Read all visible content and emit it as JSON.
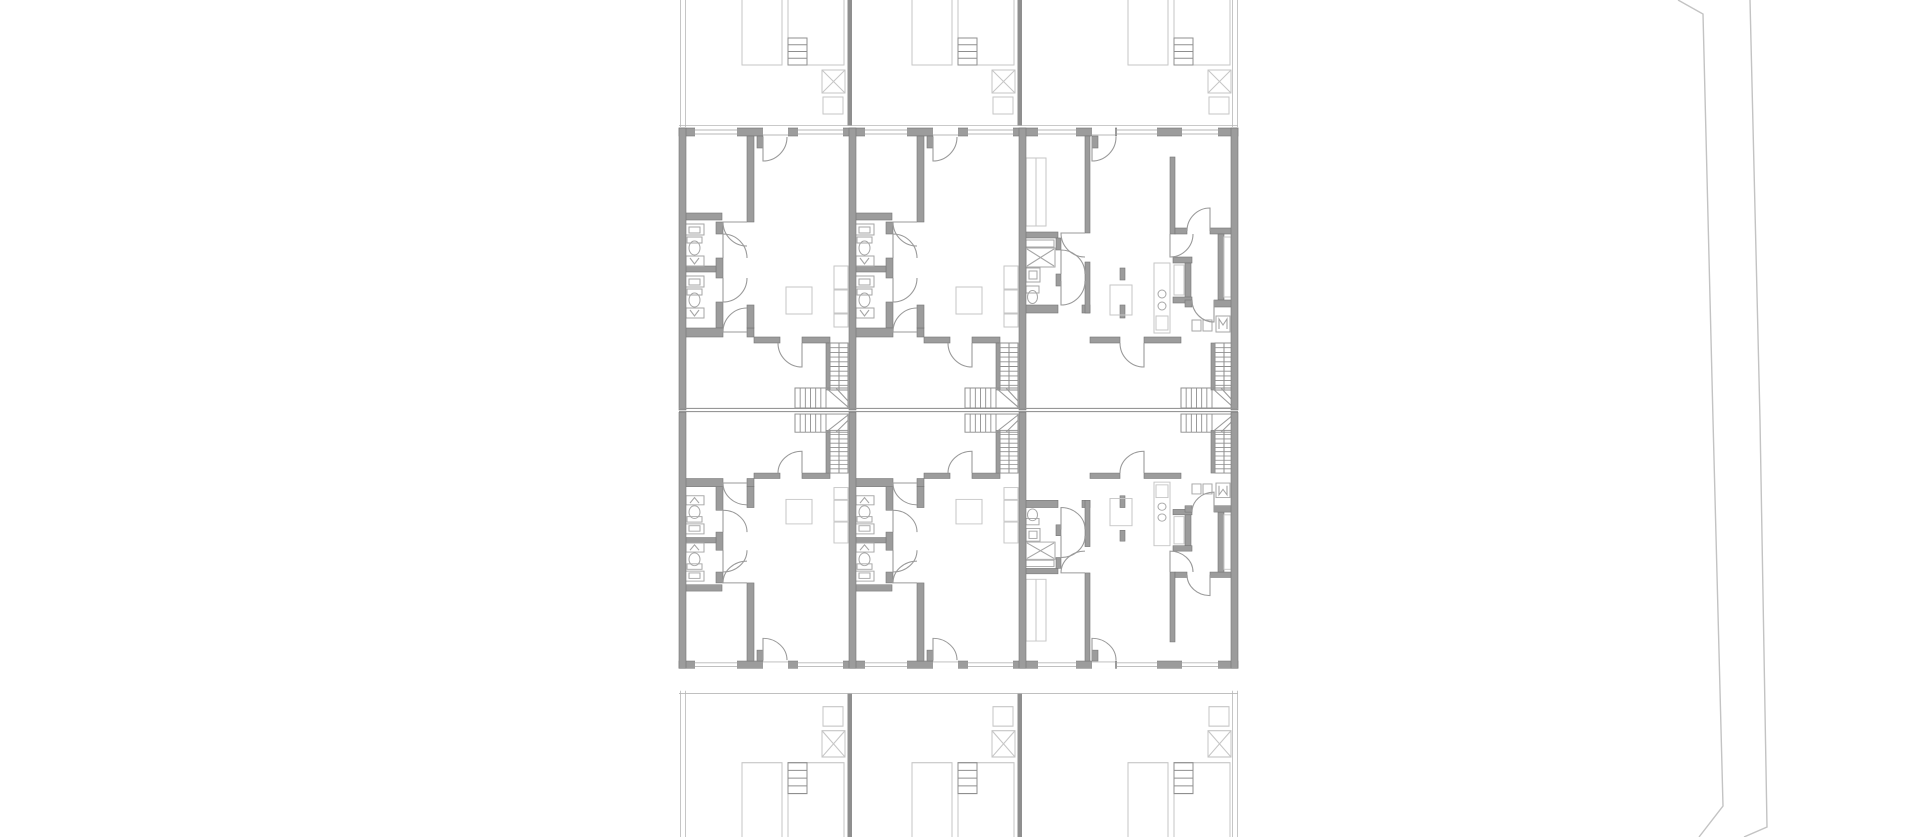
{
  "meta": {
    "drawing_label": "architectural-floor-plan",
    "background": "#ffffff"
  },
  "palette": {
    "wall_fill": "#9c9c9c",
    "wall_edge": "#757575",
    "fixture": "#a6a6a6",
    "light": "#c6c6c6",
    "stair": "#8f8f8f",
    "door": "#9a9a9a",
    "sill": "#b7b7b7",
    "road": "#c3c3c3",
    "mirror_line": "#979797"
  },
  "plan": {
    "left": 679,
    "right": 1238,
    "top_wall_y": 128,
    "top_wall_h": 8,
    "mirror_y": [
      408.4,
      411.6
    ],
    "apartment_mirror_transform": "translate(0,784.5) scale(1,-0.908)",
    "yard_mirror_transform": "translate(0,837) scale(1,-1.143)",
    "party_walls_x": [
      679,
      849,
      1019,
      1231
    ],
    "party_wall_w": 7,
    "yard_dividers_x": [
      847.5,
      1017.5
    ],
    "yard_boundary_x": [
      680.5,
      685.5,
      1232.5,
      1237.5
    ],
    "yard_edge_y": 125.5,
    "units": [
      {
        "x": 682,
        "template": "A",
        "yard": "yardA"
      },
      {
        "x": 852,
        "template": "A",
        "yard": "yardA"
      },
      {
        "x": 1022,
        "template": "B",
        "yard": "yardB"
      }
    ],
    "templates": {
      "A": {
        "windows": [
          [
            13,
            42
          ],
          [
            116,
            45
          ]
        ],
        "door": [
          81,
          25
        ],
        "prims": [
          [
            "w",
            65,
            136,
            7,
            86
          ],
          [
            "w",
            75,
            136,
            6,
            12
          ],
          [
            "w",
            3,
            213,
            37,
            7
          ],
          [
            "w",
            34,
            222,
            7,
            12
          ],
          [
            "w",
            34,
            258,
            7,
            20
          ],
          [
            "w",
            34,
            302,
            7,
            26
          ],
          [
            "w",
            3,
            266,
            31,
            6
          ],
          [
            "w",
            3,
            328,
            38,
            9
          ],
          [
            "w",
            65,
            328,
            7,
            9
          ],
          [
            "w",
            65,
            305,
            7,
            23
          ],
          [
            "w",
            72,
            337,
            26,
            6
          ],
          [
            "w",
            120,
            337,
            28,
            6
          ],
          [
            "w",
            144,
            343,
            4,
            47
          ],
          [
            "f",
            3,
            224,
            19,
            11
          ],
          [
            "f",
            7,
            227,
            11,
            6
          ],
          [
            "f",
            5,
            237,
            15,
            6
          ],
          [
            "e",
            12.5,
            248,
            5.5,
            7
          ],
          [
            "f",
            4,
            256,
            18,
            10
          ],
          [
            "pf",
            "M8 258 L12.5 264 L17 258"
          ],
          [
            "f",
            3,
            276,
            19,
            11
          ],
          [
            "f",
            7,
            279,
            11,
            6
          ],
          [
            "f",
            5,
            289,
            15,
            6
          ],
          [
            "e",
            12.5,
            300,
            5.5,
            7
          ],
          [
            "f",
            4,
            308,
            18,
            10
          ],
          [
            "pf",
            "M8 310 L12.5 316 L17 310"
          ],
          [
            "g",
            104,
            287,
            26,
            27
          ],
          [
            "g",
            152,
            266,
            14,
            23
          ],
          [
            "g",
            152,
            290,
            14,
            23
          ],
          [
            "g",
            152,
            314,
            14,
            13
          ],
          [
            "sv",
            148,
            343,
            18,
            47,
            9
          ],
          [
            "ml",
            157,
            343,
            157,
            390
          ],
          [
            "sv",
            113,
            388,
            53,
            20,
            0
          ],
          [
            "sh",
            113,
            388,
            31,
            20,
            6
          ],
          [
            "p",
            "M144 388 L166 407"
          ],
          [
            "p",
            "M154 388 L166 401"
          ],
          [
            "p",
            "M81 137 L81 161 A24 24 0 0 0 105 137"
          ],
          [
            "p",
            "M65 222 L41 222 A24 24 0 0 0 65 246"
          ],
          [
            "p",
            "M41 258 L41 234 A24 24 0 0 1 65 258"
          ],
          [
            "p",
            "M41 278 L41 302 A24 24 0 0 0 65 278"
          ],
          [
            "p",
            "M65 332 L41 332 A24 24 0 0 1 65 308"
          ],
          [
            "p",
            "M120 343 L120 367 A24 24 0 0 1 96 343"
          ]
        ]
      },
      "B": {
        "windows": [
          [
            16,
            38
          ],
          [
            95,
            40
          ],
          [
            160,
            36
          ]
        ],
        "door": [
          70,
          23
        ],
        "prims": [
          [
            "w",
            63,
            136,
            5,
            97
          ],
          [
            "w",
            70,
            136,
            6,
            12
          ],
          [
            "w",
            3,
            232,
            33,
            6
          ],
          [
            "w",
            34,
            238,
            5,
            12
          ],
          [
            "w",
            34,
            274,
            5,
            12
          ],
          [
            "w",
            0,
            305,
            36,
            8
          ],
          [
            "w",
            60,
            305,
            8,
            8
          ],
          [
            "w",
            63,
            262,
            5,
            51
          ],
          [
            "w",
            68,
            337,
            30,
            6
          ],
          [
            "w",
            122,
            337,
            37,
            6
          ],
          [
            "w",
            189,
            343,
            4,
            47
          ],
          [
            "w",
            148,
            157,
            5,
            77
          ],
          [
            "w",
            153,
            228,
            12,
            6
          ],
          [
            "w",
            188,
            228,
            23,
            6
          ],
          [
            "w",
            151,
            257,
            19,
            6
          ],
          [
            "w",
            163,
            263,
            6,
            40
          ],
          [
            "w",
            151,
            297,
            19,
            6
          ],
          [
            "w",
            196,
            234,
            6,
            66
          ],
          [
            "w",
            163,
            300,
            7,
            7
          ],
          [
            "w",
            192,
            300,
            19,
            7
          ],
          [
            "w",
            98,
            268,
            5,
            12
          ],
          [
            "w",
            98,
            305,
            5,
            13
          ],
          [
            "g",
            4,
            158,
            20,
            68
          ],
          [
            "gl",
            14,
            158,
            14,
            226
          ],
          [
            "f",
            4,
            240,
            28,
            7
          ],
          [
            "f",
            4,
            248,
            29,
            19
          ],
          [
            "pf",
            "M5 249 L32 266"
          ],
          [
            "pf",
            "M32 249 L5 266"
          ],
          [
            "f",
            4,
            268,
            14,
            14
          ],
          [
            "f",
            7,
            271,
            8,
            8
          ],
          [
            "f",
            4,
            286,
            13,
            7
          ],
          [
            "e",
            10.5,
            297,
            5,
            6.5
          ],
          [
            "g",
            132,
            263,
            16,
            70
          ],
          [
            "g",
            134,
            316,
            12,
            14
          ],
          [
            "c",
            140,
            294,
            4
          ],
          [
            "c",
            140,
            306,
            4
          ],
          [
            "g",
            152,
            265,
            10,
            30
          ],
          [
            "g",
            202,
            237,
            7,
            60
          ],
          [
            "f",
            170,
            320,
            9,
            11
          ],
          [
            "f",
            181,
            320,
            9,
            11
          ],
          [
            "f",
            194,
            316,
            14,
            16
          ],
          [
            "pf",
            "M197 329 L197 319 L201 325 L205 319 L205 329"
          ],
          [
            "g",
            88,
            285,
            22,
            30
          ],
          [
            "sv",
            193,
            343,
            18,
            47,
            9
          ],
          [
            "ml",
            202,
            343,
            202,
            390
          ],
          [
            "sv",
            159,
            388,
            52,
            20,
            0
          ],
          [
            "sh",
            159,
            388,
            31,
            20,
            6
          ],
          [
            "p",
            "M190 388 L211 407"
          ],
          [
            "p",
            "M199 388 L211 401"
          ],
          [
            "p",
            "M70 137 L70 161 A24 24 0 0 0 94 137"
          ],
          [
            "p",
            "M63 233 L39 233 A24 24 0 0 0 63 257"
          ],
          [
            "p",
            "M39 274 L39 250 A24 24 0 0 1 63 274"
          ],
          [
            "p",
            "M39 281 L39 305 A24 24 0 0 0 63 281"
          ],
          [
            "p",
            "M122 343 L122 367 A24 24 0 0 1 98 343"
          ],
          [
            "p",
            "M188 231 L188 208 A23 23 0 0 0 165 231"
          ],
          [
            "p",
            "M148 234 L148 257 A23 23 0 0 0 171 234"
          ],
          [
            "p",
            "M192 300 L192 322 A22 22 0 0 1 170 300"
          ]
        ]
      },
      "yardA": {
        "prims": [
          [
            "g",
            60,
            -20,
            40,
            85
          ],
          [
            "g",
            106,
            -20,
            56,
            85
          ],
          [
            "sv",
            106,
            38,
            19,
            27,
            3
          ],
          [
            "g",
            140,
            70,
            23,
            23
          ],
          [
            "gl",
            140,
            70,
            163,
            93
          ],
          [
            "gl",
            163,
            70,
            140,
            93
          ],
          [
            "g",
            141,
            97,
            20,
            17
          ]
        ]
      },
      "yardB": {
        "prims": [
          [
            "g",
            106,
            -20,
            40,
            85
          ],
          [
            "g",
            152,
            -20,
            56,
            85
          ],
          [
            "sv",
            152,
            38,
            19,
            27,
            3
          ],
          [
            "g",
            186,
            70,
            23,
            23
          ],
          [
            "gl",
            186,
            70,
            209,
            93
          ],
          [
            "gl",
            209,
            70,
            186,
            93
          ],
          [
            "g",
            187,
            97,
            20,
            17
          ]
        ]
      }
    },
    "road": {
      "paths": [
        "M1678 0 L1703 14 L1713 420 L1723 806 L1699 837",
        "M1750 0 L1760 420 L1767 827 L1744 837"
      ]
    }
  }
}
